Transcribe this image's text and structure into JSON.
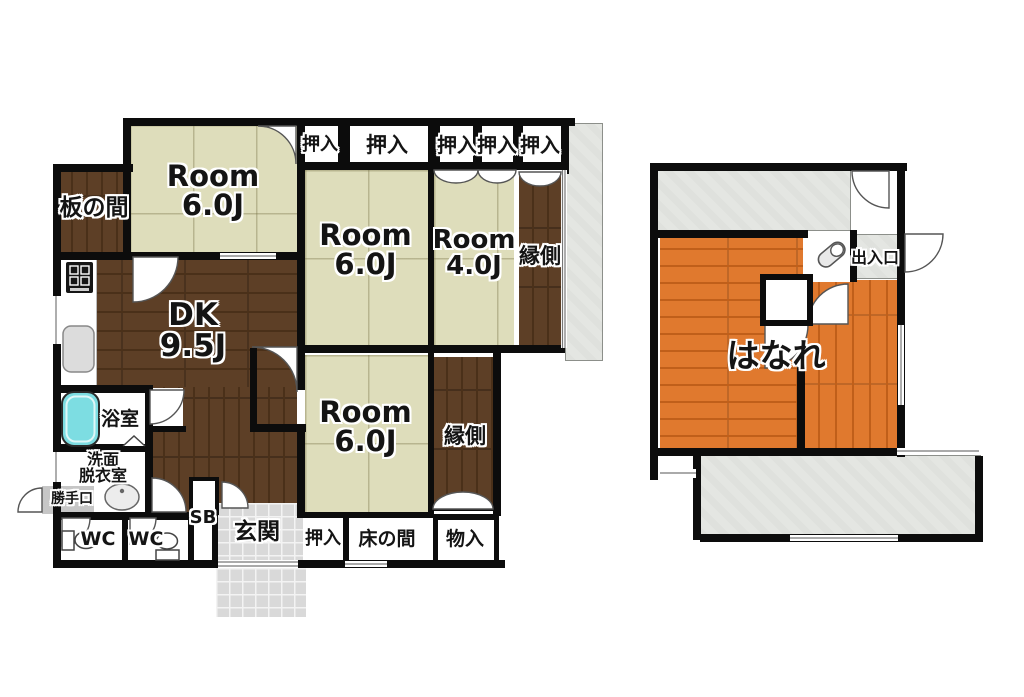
{
  "title": "間取り図 (floor plan)",
  "colors": {
    "wall": "#0c0c0c",
    "tatami": "#deddbb",
    "wood": "#5d3f26",
    "orange": "#e0792e",
    "tile": "#d9d9d9",
    "concrete": "#e4e6e2",
    "tub": "#7ddde2",
    "step": "#c6c6c6"
  },
  "labels": {
    "itanoma": "板の間",
    "room_6j": "Room\n6.0J",
    "room_4j": "Room\n4.0J",
    "oshiire": "押入",
    "engawa": "縁側",
    "dk": "DK\n9.5J",
    "bathroom": "浴室",
    "washroom": "洗面\n脱衣室",
    "katteguchi": "勝手口",
    "wc": "WC",
    "sb": "SB",
    "genkan": "玄関",
    "tokonoma": "床の間",
    "mononyu": "物入",
    "hanare": "はなれ",
    "deiriguchi": "出入口"
  },
  "rooms": [
    {
      "id": "itanoma",
      "label": "板の間",
      "floor": "wood"
    },
    {
      "id": "room-6j-upper",
      "label": "Room 6.0J",
      "floor": "tatami"
    },
    {
      "id": "room-6j-middle",
      "label": "Room 6.0J",
      "floor": "tatami"
    },
    {
      "id": "room-4j",
      "label": "Room 4.0J",
      "floor": "tatami"
    },
    {
      "id": "room-6j-lower",
      "label": "Room 6.0J",
      "floor": "tatami"
    },
    {
      "id": "dk",
      "label": "DK 9.5J",
      "floor": "wood"
    },
    {
      "id": "engawa-upper",
      "label": "縁側",
      "floor": "wood"
    },
    {
      "id": "engawa-lower",
      "label": "縁側",
      "floor": "wood"
    },
    {
      "id": "bathroom",
      "label": "浴室",
      "floor": "white"
    },
    {
      "id": "washroom",
      "label": "洗面脱衣室",
      "floor": "white"
    },
    {
      "id": "wc-1",
      "label": "WC",
      "floor": "white"
    },
    {
      "id": "wc-2",
      "label": "WC",
      "floor": "white"
    },
    {
      "id": "shoe-box",
      "label": "SB",
      "floor": "white"
    },
    {
      "id": "genkan",
      "label": "玄関",
      "floor": "tile"
    },
    {
      "id": "kitchen-back-door",
      "label": "勝手口",
      "floor": "step"
    },
    {
      "id": "oshiire-top-count",
      "label": "押入 ×5",
      "floor": "closet"
    },
    {
      "id": "oshiire-bottom",
      "label": "押入",
      "floor": "closet"
    },
    {
      "id": "tokonoma",
      "label": "床の間",
      "floor": "closet"
    },
    {
      "id": "mononyu",
      "label": "物入",
      "floor": "closet"
    },
    {
      "id": "hanare",
      "label": "はなれ",
      "floor": "orange-wood"
    },
    {
      "id": "deiriguchi",
      "label": "出入口",
      "floor": "concrete"
    }
  ]
}
